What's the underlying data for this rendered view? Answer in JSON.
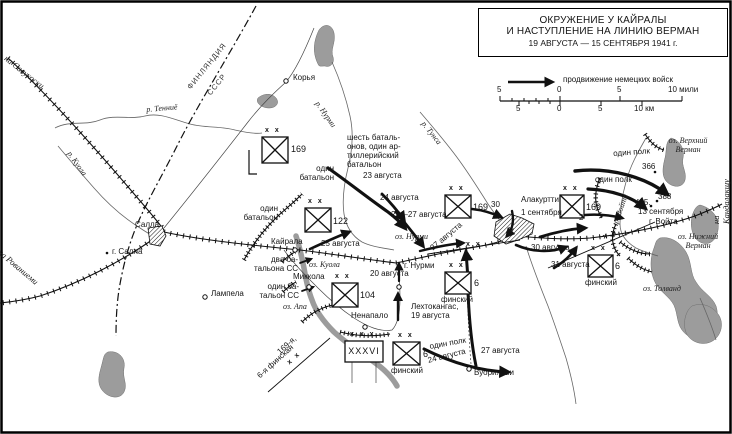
{
  "colors": {
    "ink": "#1a1a1a",
    "lake": "#9c9c9c",
    "river": "#666666"
  },
  "title": {
    "line1": "ОКРУЖЕНИЕ У КАЙРАЛЫ",
    "line2": "И НАСТУПЛЕНИЕ НА ЛИНИЮ ВЕРМАН",
    "line3": "19 АВГУСТА — 15 СЕНТЯБРЯ 1941 г."
  },
  "legend": {
    "advance": "продвижение немецких войск"
  },
  "scale": {
    "miles": [
      "5",
      "0",
      "5",
      "10 мили"
    ],
    "km": [
      "5",
      "0",
      "5",
      "10 км"
    ]
  },
  "borders": {
    "finland": "ФИНЛЯНДИЯ",
    "ussr": "СССР"
  },
  "edges": {
    "savukoski": "на Савукоски",
    "rovaniemi": "на Рованиеми",
    "kandalaksha": "на Кандалакшу"
  },
  "places": {
    "korya": "Корья",
    "salla": "Салла",
    "g_salla": "г. Салла",
    "kayrala": "Кайрала",
    "mikkola": "Миккола",
    "lampela": "Лампела",
    "nenapalo": "Ненапало",
    "vuoriyarvi": "Вуориярви",
    "alakurtti": "Алакуртти",
    "g_nurmi": "г. Нурми",
    "g_voyta": "г. Войта",
    "h366": "366",
    "h388": "388",
    "h425": "425."
  },
  "waters": {
    "tennie": "р. Тенниё",
    "kuola_r": "р. Куола",
    "nurmi_r": "р. Нурми",
    "tunsa": "р. Тунса",
    "voyta_r": "р. Войта",
    "oz_nurmi": "оз. Нурми",
    "oz_kuola": "оз. Куола",
    "oz_apa": "оз. Апа",
    "oz_verh": "оз. Верхний\nВерман",
    "oz_nizh": "оз. Нижний\nВерман",
    "oz_tolvand": "оз. Толванд"
  },
  "dates": {
    "aug23": "23 августа",
    "aug24": "24 августа",
    "aug25_27": "25—27 августа",
    "aug25": "25 августа",
    "aug20": "20 августа",
    "aug27_c": "27 августа",
    "d30": "30",
    "d31": "31",
    "aug30": "30 августа",
    "aug31": "31 августа",
    "sep1": "1 сентября",
    "sep13": "13 сентября",
    "d2": "2",
    "aug27_s": "27 августа",
    "lehtokangas": "Лехтокангас,\n19 августа"
  },
  "notes": {
    "six_bat": "шесть баталь-\nонов, один ар-\nтиллерийский\nбатальон",
    "one_bat_n": "один\nбатальон",
    "one_bat_w": "один\nбатальон",
    "two_bat_ss": "два ба-\nтальона СС",
    "one_bat_ss": "один ба-\nтальон СС",
    "one_polk_s": "один полк",
    "aug24_s": "24 августа",
    "one_polk_e1": "один полк",
    "one_polk_e2": "один полк"
  },
  "boundaries": {
    "n169": "169-я,",
    "xx_sw": "х х",
    "fin6": "6-я финская",
    "xx_c": "х х",
    "xx_e": "х х"
  },
  "units": {
    "size_div": "х х",
    "size_corps": "х х х",
    "fin": "финский",
    "d169w": "169",
    "d122": "122",
    "d104": "104",
    "d6sw": "6",
    "c36": "XXXVI",
    "d6c": "6",
    "d169c": "169",
    "d169e": "169",
    "d6e": "6"
  }
}
